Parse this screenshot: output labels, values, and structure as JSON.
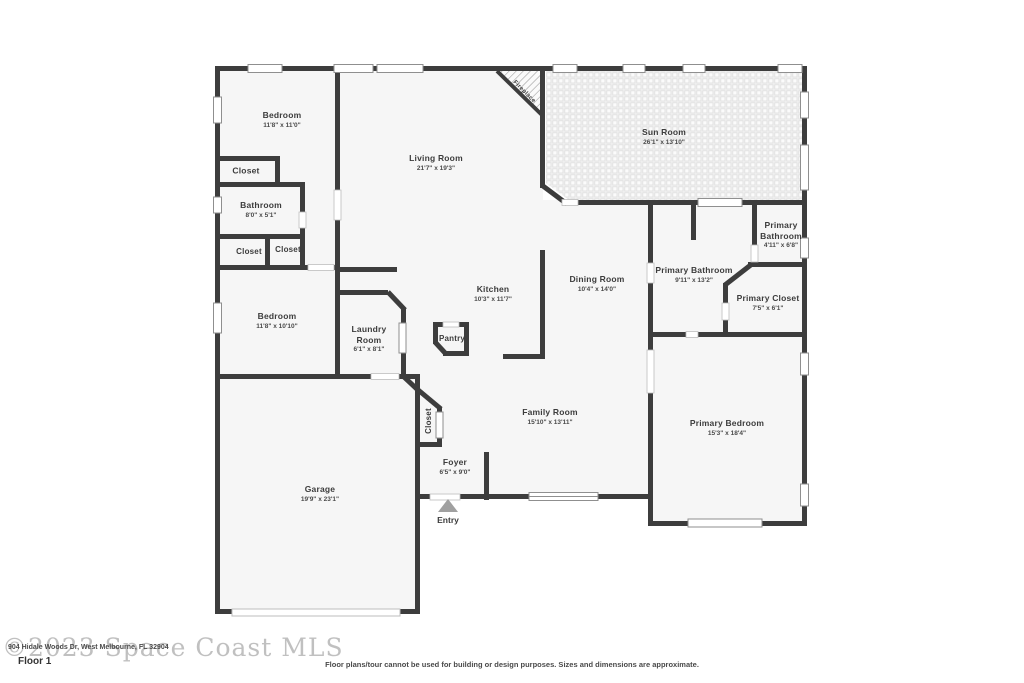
{
  "rooms": {
    "bedroom_top": {
      "name": "Bedroom",
      "dims": "11'8\" x 11'0\""
    },
    "closet_bedroom_top": {
      "name": "Closet"
    },
    "bathroom": {
      "name": "Bathroom",
      "dims": "8'0\" x 5'1\""
    },
    "closet_hall_left": {
      "name": "Closet"
    },
    "closet_hall_right": {
      "name": "Closet"
    },
    "living_room": {
      "name": "Living Room",
      "dims": "21'7\" x 19'3\""
    },
    "fireplace": {
      "name": "Fireplace"
    },
    "sun_room": {
      "name": "Sun Room",
      "dims": "26'1\" x 13'10\""
    },
    "primary_bathroom_small": {
      "name_line1": "Primary",
      "name_line2": "Bathroom",
      "dims": "4'11\" x 6'8\""
    },
    "primary_bathroom_large": {
      "name": "Primary Bathroom",
      "dims": "9'11\" x 13'2\""
    },
    "primary_closet": {
      "name": "Primary Closet",
      "dims": "7'5\" x 6'1\""
    },
    "dining_room": {
      "name": "Dining Room",
      "dims": "10'4\" x 14'0\""
    },
    "kitchen": {
      "name": "Kitchen",
      "dims": "10'3\" x 11'7\""
    },
    "pantry": {
      "name": "Pantry"
    },
    "bedroom_middle": {
      "name": "Bedroom",
      "dims": "11'8\" x 10'10\""
    },
    "laundry_room": {
      "name_line1": "Laundry",
      "name_line2": "Room",
      "dims": "6'1\" x 8'1\""
    },
    "closet_foyer": {
      "name": "Closet"
    },
    "family_room": {
      "name": "Family Room",
      "dims": "15'10\" x 13'11\""
    },
    "foyer": {
      "name": "Foyer",
      "dims": "6'5\" x 9'0\""
    },
    "garage": {
      "name": "Garage",
      "dims": "19'9\" x 23'1\""
    },
    "primary_bedroom": {
      "name": "Primary Bedroom",
      "dims": "15'3\" x 18'4\""
    },
    "entry": {
      "name": "Entry"
    }
  },
  "footer": {
    "floor_label": "Floor 1",
    "watermark": "©2023 Space Coast MLS",
    "address": "904 Hidale Woods Dr, West Melbourne, FL 32904",
    "disclaimer": "Floor plans/tour cannot be used for building or design purposes. Sizes and dimensions are approximate."
  },
  "colors": {
    "wall": "#3d3d3d",
    "floor": "#f6f6f6",
    "window_border": "#8f8f8f",
    "entry_arrow": "#a0a0a0",
    "label_text": "#3c3c3c"
  }
}
